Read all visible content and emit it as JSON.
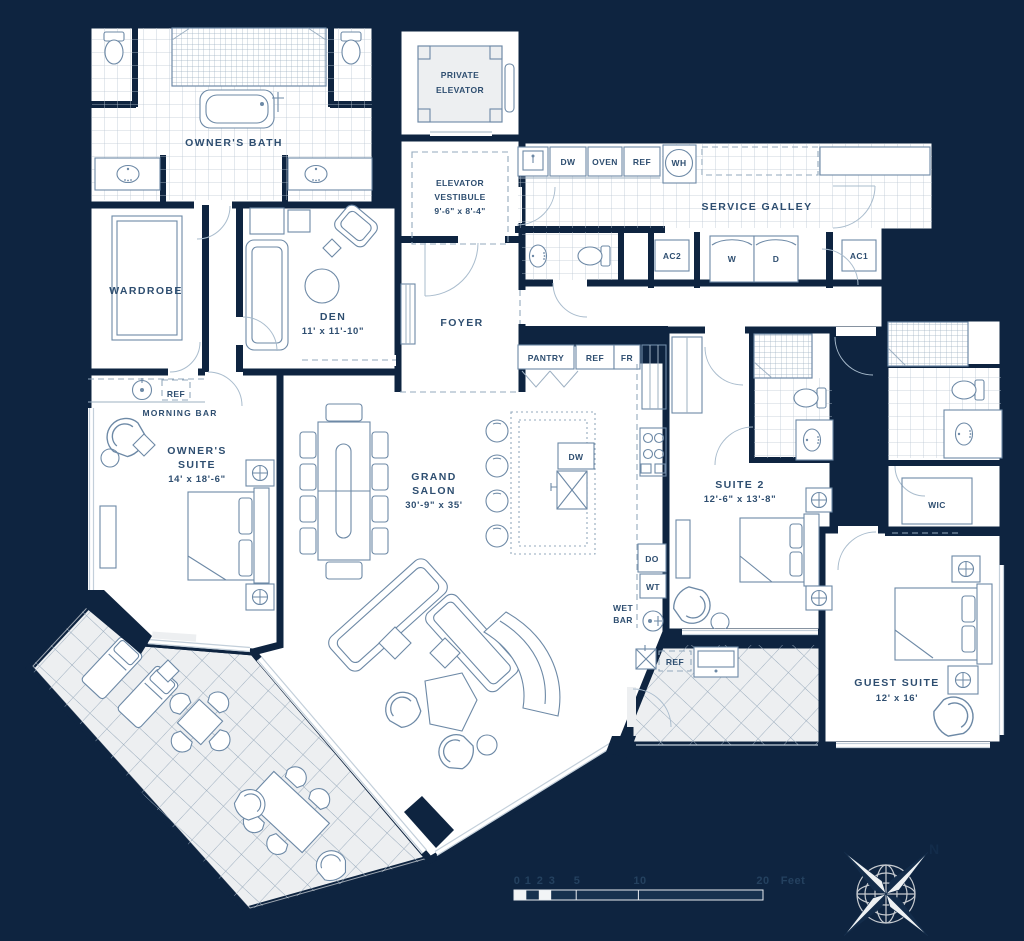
{
  "title": "Residence Floor Plan",
  "labels": {
    "owners_bath": "OWNER'S BATH",
    "private_elevator_1": "PRIVATE",
    "private_elevator_2": "ELEVATOR",
    "vestibule_1": "ELEVATOR",
    "vestibule_2": "VESTIBULE",
    "vestibule_dims": "9'-6\" x 8'-4\"",
    "service_galley": "SERVICE GALLEY",
    "wardrobe": "WARDROBE",
    "den": "DEN",
    "den_dims": "11' x 11'-10\"",
    "foyer": "FOYER",
    "morning_bar": "MORNING BAR",
    "owners_suite_1": "OWNER'S",
    "owners_suite_2": "SUITE",
    "owners_suite_dims": "14' x 18'-6\"",
    "grand_salon_1": "GRAND",
    "grand_salon_2": "SALON",
    "grand_salon_dims": "30'-9\" x 35'",
    "suite2": "SUITE 2",
    "suite2_dims": "12'-6\" x 13'-8\"",
    "wic": "WIC",
    "guest_suite": "GUEST SUITE",
    "guest_suite_dims": "12' x 16'",
    "wet_bar_1": "WET",
    "wet_bar_2": "BAR"
  },
  "appliances": {
    "dw": "DW",
    "oven": "OVEN",
    "ref_galley": "REF",
    "wh": "WH",
    "ac2": "AC2",
    "washer": "W",
    "dryer": "D",
    "ac1": "AC1",
    "pantry": "PANTRY",
    "ref_kitchen": "REF",
    "fr": "FR",
    "dw_island": "DW",
    "do": "DO",
    "wt": "WT",
    "ref_morning_bar": "REF",
    "ref_terrace": "REF"
  },
  "scale_bar": {
    "t0": "0",
    "t1": "1",
    "t2": "2",
    "t3": "3",
    "t5": "5",
    "t10": "10",
    "t20": "20",
    "unit": "Feet"
  },
  "compass": {
    "north": "N"
  },
  "colors": {
    "background": "#0e2440",
    "wall": "#0e2440",
    "line": "#6d89a6",
    "text": "#2e4e70",
    "tile": "#edeff1"
  }
}
